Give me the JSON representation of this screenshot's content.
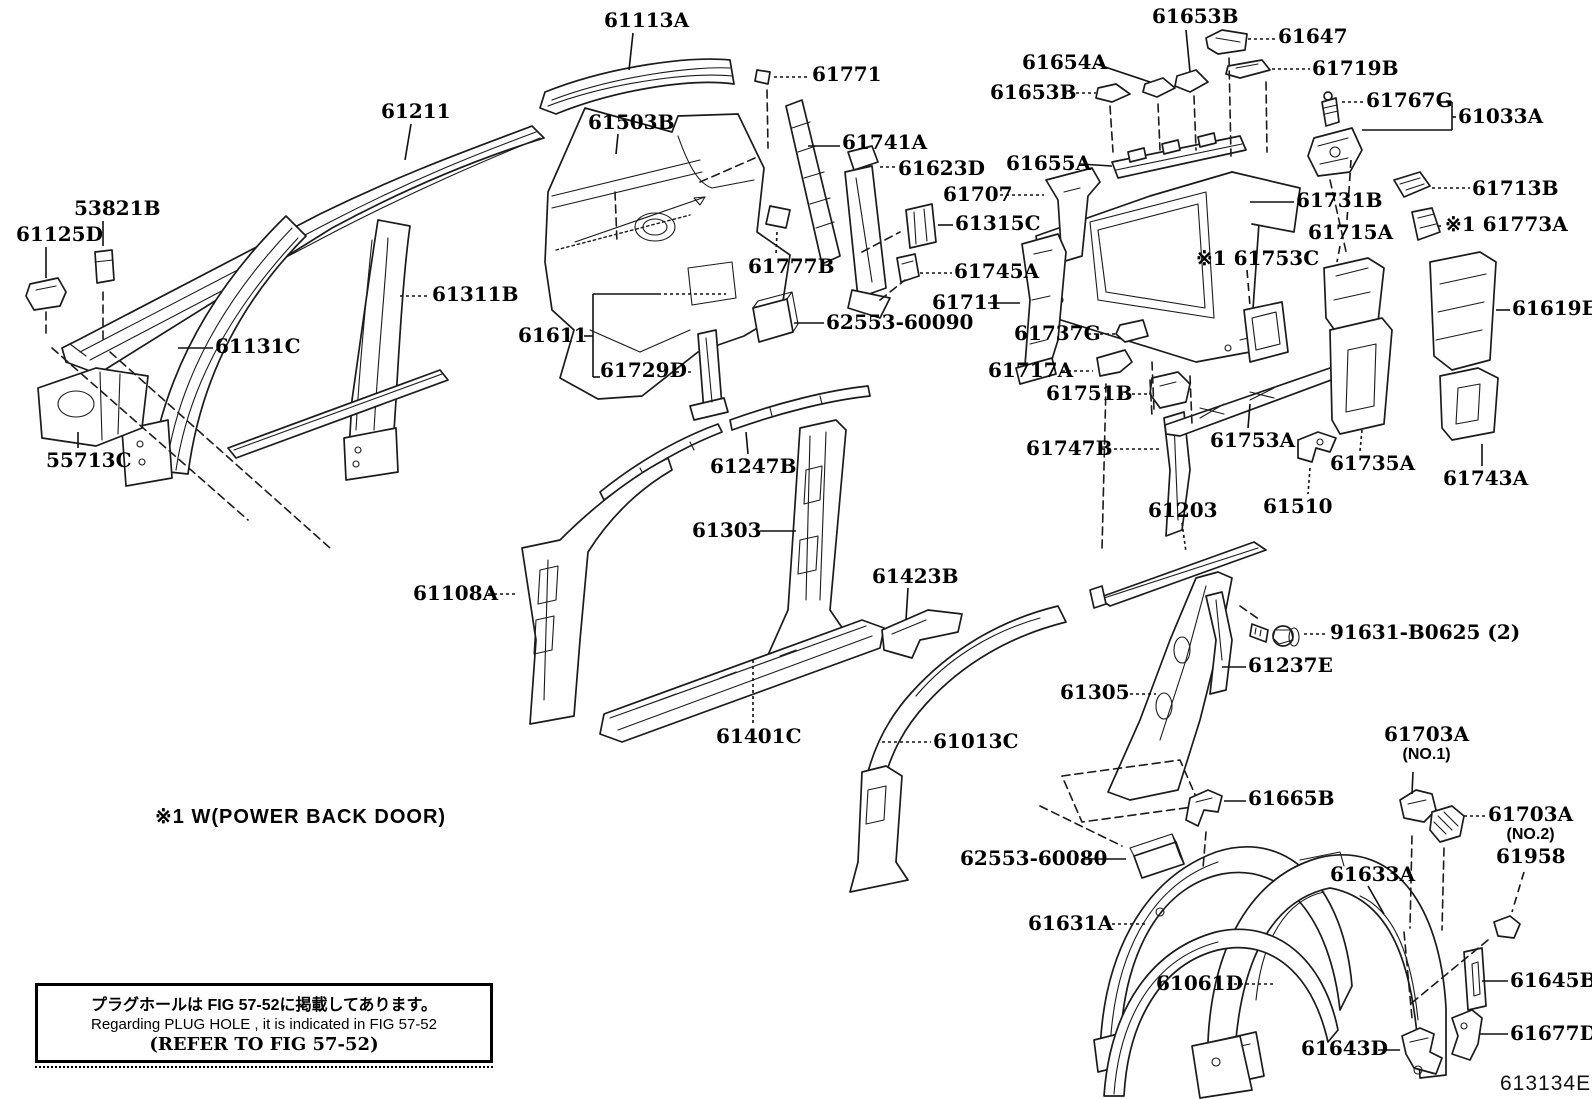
{
  "figure_code": "613134E",
  "footnote": "※1  W(POWER BACK DOOR)",
  "note_box": {
    "line1": "プラグホールは FIG  57-52に掲載してあります。",
    "line2": "Regarding  PLUG  HOLE , it is indicated in FIG  57-52",
    "line3": "(REFER TO FIG 57-52)"
  },
  "callouts": [
    {
      "part": "61113A",
      "x": 604,
      "y": 10,
      "leaders": [
        [
          633,
          33,
          629,
          70,
          "s"
        ]
      ]
    },
    {
      "part": "61211",
      "x": 381,
      "y": 101,
      "leaders": [
        [
          411,
          124,
          405,
          160,
          "s"
        ]
      ]
    },
    {
      "part": "61503B",
      "x": 588,
      "y": 112,
      "leaders": [
        [
          618,
          134,
          616,
          154,
          "s"
        ]
      ]
    },
    {
      "part": "61771",
      "x": 812,
      "y": 64,
      "leaders": [
        [
          774,
          77,
          810,
          77,
          "d"
        ]
      ]
    },
    {
      "part": "61741A",
      "x": 842,
      "y": 132,
      "leaders": [
        [
          808,
          146,
          840,
          146,
          "s"
        ]
      ]
    },
    {
      "part": "61623D",
      "x": 898,
      "y": 158,
      "leaders": [
        [
          880,
          167,
          896,
          167,
          "d"
        ]
      ]
    },
    {
      "part": "61653B",
      "x": 1152,
      "y": 6,
      "leaders": [
        [
          1186,
          30,
          1190,
          72,
          "s"
        ]
      ]
    },
    {
      "part": "61647",
      "x": 1278,
      "y": 26,
      "leaders": [
        [
          1248,
          39,
          1276,
          39,
          "d"
        ]
      ]
    },
    {
      "part": "61654A",
      "x": 1022,
      "y": 52,
      "leaders": [
        [
          1096,
          64,
          1150,
          82,
          "s"
        ]
      ]
    },
    {
      "part": "61653B",
      "x": 990,
      "y": 82,
      "leaders": [
        [
          1064,
          93,
          1096,
          93,
          "d"
        ]
      ]
    },
    {
      "part": "61719B",
      "x": 1312,
      "y": 58,
      "leaders": [
        [
          1272,
          69,
          1310,
          69,
          "d"
        ]
      ]
    },
    {
      "part": "61767G",
      "x": 1366,
      "y": 90,
      "leaders": [
        [
          1342,
          102,
          1364,
          102,
          "d"
        ],
        [
          1440,
          102,
          1452,
          102,
          "s"
        ],
        [
          1452,
          102,
          1452,
          130,
          "s"
        ],
        [
          1452,
          130,
          1362,
          130,
          "s"
        ]
      ]
    },
    {
      "part": "61033A",
      "x": 1458,
      "y": 106,
      "leaders": [
        [
          1456,
          117,
          1452,
          117,
          "s"
        ]
      ]
    },
    {
      "part": "61655A",
      "x": 1006,
      "y": 153,
      "leaders": [
        [
          1080,
          164,
          1112,
          166,
          "s"
        ]
      ]
    },
    {
      "part": "61707",
      "x": 943,
      "y": 184,
      "leaders": [
        [
          1000,
          195,
          1044,
          195,
          "d"
        ]
      ]
    },
    {
      "part": "61731B",
      "x": 1296,
      "y": 190,
      "leaders": [
        [
          1250,
          202,
          1294,
          202,
          "s"
        ]
      ]
    },
    {
      "part": "61713B",
      "x": 1472,
      "y": 178,
      "leaders": [
        [
          1432,
          188,
          1470,
          188,
          "d"
        ]
      ]
    },
    {
      "part": "61773A",
      "prefix": "※1",
      "x": 1445,
      "y": 214,
      "leaders": [
        [
          1438,
          226,
          1443,
          226,
          "d"
        ]
      ]
    },
    {
      "part": "61315C",
      "x": 955,
      "y": 213,
      "leaders": [
        [
          938,
          225,
          953,
          225,
          "s"
        ]
      ]
    },
    {
      "part": "61715A",
      "x": 1308,
      "y": 222,
      "leaders": [
        [
          1340,
          246,
          1337,
          262,
          "D"
        ],
        [
          1351,
          160,
          1347,
          220,
          "D"
        ]
      ]
    },
    {
      "part": "61753C",
      "prefix": "※1",
      "x": 1196,
      "y": 248,
      "leaders": [
        [
          1247,
          270,
          1250,
          306,
          "D"
        ]
      ]
    },
    {
      "part": "61745A",
      "x": 954,
      "y": 261,
      "leaders": [
        [
          920,
          273,
          952,
          273,
          "d"
        ]
      ]
    },
    {
      "part": "61711",
      "x": 932,
      "y": 292,
      "leaders": [
        [
          988,
          303,
          1020,
          303,
          "s"
        ]
      ]
    },
    {
      "part": "61619E",
      "x": 1512,
      "y": 298,
      "leaders": [
        [
          1496,
          310,
          1510,
          310,
          "s"
        ]
      ]
    },
    {
      "part": "61311B",
      "x": 432,
      "y": 284,
      "leaders": [
        [
          400,
          296,
          430,
          296,
          "d"
        ]
      ]
    },
    {
      "part": "61611",
      "x": 518,
      "y": 325,
      "leaders": [
        [
          584,
          336,
          593,
          336,
          "s"
        ],
        [
          593,
          294,
          593,
          377,
          "s"
        ],
        [
          593,
          294,
          658,
          294,
          "s"
        ],
        [
          658,
          294,
          726,
          294,
          "d"
        ],
        [
          593,
          377,
          600,
          377,
          "s"
        ]
      ]
    },
    {
      "part": "61737G",
      "x": 1014,
      "y": 323,
      "leaders": [
        [
          1088,
          334,
          1116,
          334,
          "d"
        ]
      ]
    },
    {
      "part": "62553-60090",
      "x": 826,
      "y": 312,
      "leaders": [
        [
          794,
          323,
          824,
          323,
          "s"
        ]
      ]
    },
    {
      "part": "61777B",
      "x": 748,
      "y": 256,
      "leaders": [
        [
          777,
          232,
          776,
          254,
          "d"
        ]
      ]
    },
    {
      "part": "61729D",
      "x": 600,
      "y": 360,
      "leaders": [
        [
          676,
          372,
          694,
          372,
          "d"
        ]
      ]
    },
    {
      "part": "55713C",
      "x": 46,
      "y": 450,
      "leaders": [
        [
          78,
          432,
          78,
          448,
          "s"
        ]
      ]
    },
    {
      "part": "53821B",
      "x": 74,
      "y": 198,
      "leaders": [
        [
          103,
          221,
          103,
          246,
          "s"
        ]
      ]
    },
    {
      "part": "61125D",
      "x": 16,
      "y": 224,
      "leaders": [
        [
          46,
          247,
          46,
          278,
          "s"
        ]
      ]
    },
    {
      "part": "61131C",
      "x": 215,
      "y": 336,
      "leaders": [
        [
          178,
          348,
          213,
          348,
          "s"
        ]
      ]
    },
    {
      "part": "61717A",
      "x": 988,
      "y": 360,
      "leaders": [
        [
          1062,
          371,
          1093,
          371,
          "d"
        ]
      ]
    },
    {
      "part": "61751B",
      "x": 1046,
      "y": 383,
      "leaders": [
        [
          1120,
          394,
          1150,
          394,
          "d"
        ]
      ]
    },
    {
      "part": "61747B",
      "x": 1026,
      "y": 438,
      "leaders": [
        [
          1102,
          449,
          1160,
          449,
          "d"
        ]
      ]
    },
    {
      "part": "61753A",
      "x": 1210,
      "y": 430,
      "leaders": [
        [
          1248,
          428,
          1250,
          404,
          "s"
        ]
      ]
    },
    {
      "part": "61735A",
      "x": 1330,
      "y": 453,
      "leaders": [
        [
          1362,
          430,
          1360,
          451,
          "d"
        ]
      ]
    },
    {
      "part": "61743A",
      "x": 1443,
      "y": 468,
      "leaders": [
        [
          1482,
          444,
          1482,
          466,
          "s"
        ]
      ]
    },
    {
      "part": "61510",
      "x": 1263,
      "y": 496,
      "leaders": [
        [
          1310,
          468,
          1308,
          494,
          "d"
        ]
      ]
    },
    {
      "part": "61247B",
      "x": 710,
      "y": 456,
      "leaders": [
        [
          748,
          454,
          746,
          432,
          "s"
        ]
      ]
    },
    {
      "part": "61203",
      "x": 1148,
      "y": 500,
      "leaders": [
        [
          1182,
          523,
          1186,
          552,
          "d"
        ]
      ]
    },
    {
      "part": "61303",
      "x": 692,
      "y": 520,
      "leaders": [
        [
          760,
          531,
          796,
          531,
          "s"
        ]
      ]
    },
    {
      "part": "61423B",
      "x": 872,
      "y": 566,
      "leaders": [
        [
          908,
          588,
          906,
          620,
          "s"
        ]
      ]
    },
    {
      "part": "61108A",
      "x": 413,
      "y": 583,
      "leaders": [
        [
          488,
          594,
          518,
          594,
          "d"
        ]
      ]
    },
    {
      "part": "91631-B0625 (2)",
      "x": 1330,
      "y": 622,
      "leaders": [
        [
          1304,
          634,
          1328,
          634,
          "d"
        ]
      ]
    },
    {
      "part": "61237E",
      "x": 1248,
      "y": 655,
      "leaders": [
        [
          1222,
          667,
          1246,
          667,
          "s"
        ]
      ]
    },
    {
      "part": "61305",
      "x": 1060,
      "y": 682,
      "leaders": [
        [
          1124,
          694,
          1156,
          694,
          "d"
        ]
      ]
    },
    {
      "part": "61401C",
      "x": 716,
      "y": 726,
      "leaders": [
        [
          753,
          660,
          753,
          724,
          "d"
        ]
      ]
    },
    {
      "part": "61013C",
      "x": 933,
      "y": 731,
      "leaders": [
        [
          882,
          742,
          931,
          742,
          "d"
        ]
      ]
    },
    {
      "part": "61703A",
      "sub": "(NO.1)",
      "x": 1384,
      "y": 724,
      "leaders": [
        [
          1413,
          772,
          1412,
          794,
          "s"
        ]
      ]
    },
    {
      "part": "61665B",
      "x": 1248,
      "y": 788,
      "leaders": [
        [
          1224,
          801,
          1246,
          801,
          "s"
        ]
      ]
    },
    {
      "part": "61703A",
      "sub": "(NO.2)",
      "x": 1488,
      "y": 804,
      "leaders": [
        [
          1464,
          816,
          1486,
          816,
          "d"
        ]
      ]
    },
    {
      "part": "61958",
      "x": 1496,
      "y": 846,
      "leaders": [
        [
          1524,
          872,
          1512,
          912,
          "D"
        ]
      ]
    },
    {
      "part": "62553-60080",
      "x": 960,
      "y": 848,
      "leaders": [
        [
          1084,
          859,
          1126,
          859,
          "s"
        ]
      ]
    },
    {
      "part": "61633A",
      "x": 1330,
      "y": 864,
      "leaders": [
        [
          1368,
          886,
          1384,
          914,
          "s"
        ]
      ]
    },
    {
      "part": "61631A",
      "x": 1028,
      "y": 913,
      "leaders": [
        [
          1106,
          924,
          1146,
          924,
          "d"
        ]
      ]
    },
    {
      "part": "61061D",
      "x": 1156,
      "y": 973,
      "leaders": [
        [
          1228,
          984,
          1276,
          984,
          "d"
        ]
      ]
    },
    {
      "part": "61645B",
      "x": 1510,
      "y": 970,
      "leaders": [
        [
          1482,
          981,
          1508,
          981,
          "s"
        ]
      ]
    },
    {
      "part": "61677D",
      "x": 1510,
      "y": 1023,
      "leaders": [
        [
          1480,
          1034,
          1508,
          1034,
          "s"
        ]
      ]
    },
    {
      "part": "61643D",
      "x": 1301,
      "y": 1038,
      "leaders": [
        [
          1378,
          1050,
          1400,
          1050,
          "s"
        ]
      ]
    }
  ]
}
